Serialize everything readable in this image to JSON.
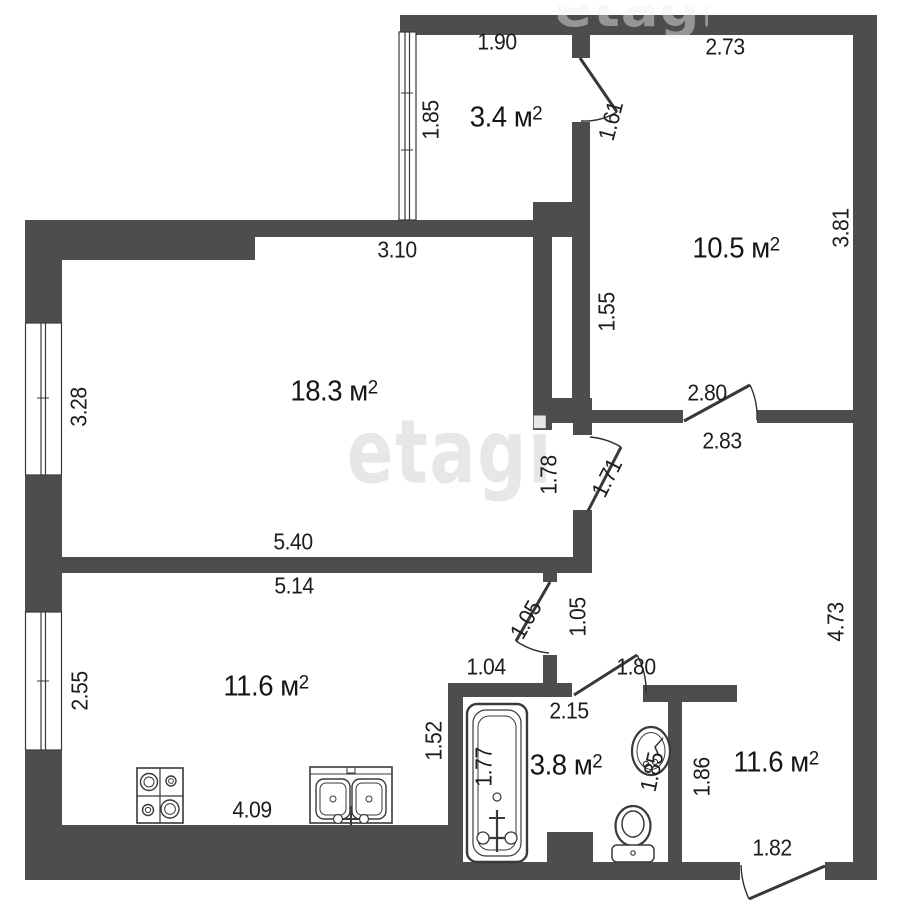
{
  "watermark": {
    "text": "etagi",
    "color": "#e7e7e7"
  },
  "colors": {
    "wall": "#4d4d4d",
    "outline": "#3a3a3a",
    "text": "#1d1d1d"
  },
  "fixtures": [
    "window-icon",
    "stove-icon",
    "kitchen-sink-icon",
    "bathtub-icon",
    "wash-basin-icon",
    "toilet-icon",
    "door-swing-icon"
  ],
  "rooms": [
    {
      "name": "balcony",
      "label": "3.4 м",
      "sup": "2",
      "x": 506,
      "y": 118
    },
    {
      "name": "room-top-right",
      "label": "10.5 м",
      "sup": "2",
      "x": 736,
      "y": 249
    },
    {
      "name": "living-room",
      "label": "18.3 м",
      "sup": "2",
      "x": 334,
      "y": 392
    },
    {
      "name": "kitchen",
      "label": "11.6 м",
      "sup": "2",
      "x": 266,
      "y": 687
    },
    {
      "name": "bathroom",
      "label": "3.8 м",
      "sup": "2",
      "x": 566,
      "y": 766
    },
    {
      "name": "entry-hall",
      "label": "11.6 м",
      "sup": "2",
      "x": 776,
      "y": 763
    }
  ],
  "dimensions": [
    {
      "t": "1.90",
      "x": 497,
      "y": 42,
      "r": 0
    },
    {
      "t": "1.85",
      "x": 431,
      "y": 120,
      "r": -90
    },
    {
      "t": "1.61",
      "x": 611,
      "y": 121,
      "r": -75
    },
    {
      "t": "2.73",
      "x": 725,
      "y": 47,
      "r": 0
    },
    {
      "t": "3.81",
      "x": 841,
      "y": 228,
      "r": -90
    },
    {
      "t": "1.55",
      "x": 607,
      "y": 312,
      "r": -90
    },
    {
      "t": "3.10",
      "x": 397,
      "y": 250,
      "r": 0
    },
    {
      "t": "3.28",
      "x": 79,
      "y": 407,
      "r": -90
    },
    {
      "t": "2.80",
      "x": 707,
      "y": 393,
      "r": 0
    },
    {
      "t": "2.83",
      "x": 722,
      "y": 441,
      "r": 0
    },
    {
      "t": "1.78",
      "x": 549,
      "y": 475,
      "r": -90
    },
    {
      "t": "1.71",
      "x": 607,
      "y": 478,
      "r": -63
    },
    {
      "t": "5.40",
      "x": 293,
      "y": 542,
      "r": 0
    },
    {
      "t": "5.14",
      "x": 294,
      "y": 586,
      "r": 0
    },
    {
      "t": "1.05",
      "x": 526,
      "y": 620,
      "r": -60
    },
    {
      "t": "1.05",
      "x": 578,
      "y": 617,
      "r": -90
    },
    {
      "t": "4.73",
      "x": 836,
      "y": 622,
      "r": -90
    },
    {
      "t": "1.04",
      "x": 486,
      "y": 667,
      "r": 0
    },
    {
      "t": "1.80",
      "x": 636,
      "y": 667,
      "r": 0
    },
    {
      "t": "2.55",
      "x": 80,
      "y": 691,
      "r": -90
    },
    {
      "t": "2.15",
      "x": 569,
      "y": 711,
      "r": 0
    },
    {
      "t": "1.52",
      "x": 434,
      "y": 741,
      "r": -90
    },
    {
      "t": "1.77",
      "x": 484,
      "y": 767,
      "r": -90
    },
    {
      "t": "1.85",
      "x": 652,
      "y": 772,
      "r": -78
    },
    {
      "t": "1.86",
      "x": 702,
      "y": 777,
      "r": -90
    },
    {
      "t": "4.09",
      "x": 252,
      "y": 810,
      "r": 0
    },
    {
      "t": "1.82",
      "x": 772,
      "y": 848,
      "r": 0
    }
  ]
}
